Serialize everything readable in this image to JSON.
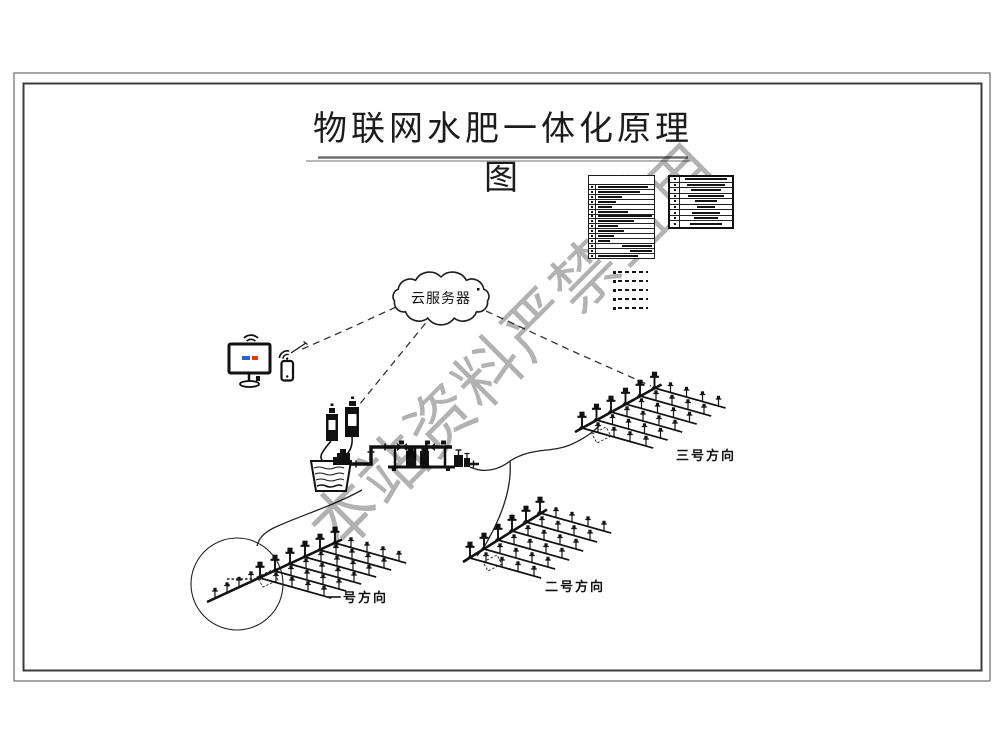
{
  "title": "物联网水肥一体化原理图",
  "cloud": {
    "label": "云服务器"
  },
  "legend": {
    "header": "图例",
    "left_table_row_count": 15,
    "right_table_row_count": 9,
    "line_sample_count": 5
  },
  "fields": [
    {
      "label": "一号方向"
    },
    {
      "label": "二号方向"
    },
    {
      "label": "三号方向"
    }
  ],
  "watermark": "本站资料严禁盗用",
  "colors": {
    "line": "#111111",
    "frame": "#555555",
    "watermark_gray": "#9a9a9a",
    "screen_blue": "#2e63c8",
    "screen_red": "#cc4125"
  }
}
